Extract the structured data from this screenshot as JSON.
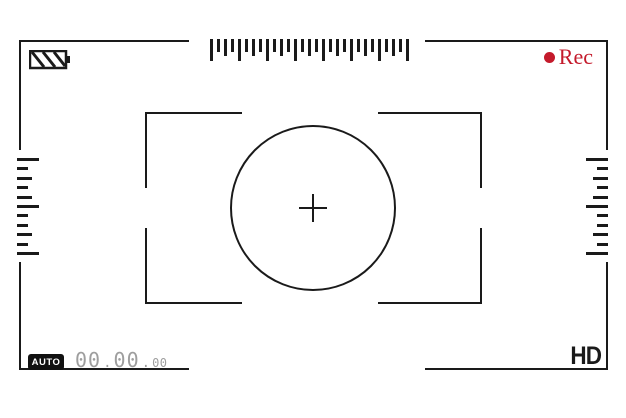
{
  "colors": {
    "line": "#1a1a1a",
    "accent_red": "#c41a2b",
    "timecode_gray": "#9e9e9e",
    "badge_bg": "#111111",
    "badge_text": "#ffffff"
  },
  "top_bar": {
    "battery_icon": "battery-icon",
    "rec": {
      "dot_icon": "record-dot-icon",
      "label": "Rec"
    }
  },
  "rulers": {
    "top": {
      "ticks": [
        "tall",
        "short",
        "mid",
        "short",
        "tall",
        "short",
        "mid",
        "short",
        "tall",
        "short",
        "mid",
        "short",
        "tall",
        "short",
        "mid",
        "short",
        "tall",
        "short",
        "mid",
        "short",
        "tall",
        "short",
        "mid",
        "short",
        "tall",
        "short",
        "mid",
        "short",
        "tall"
      ]
    },
    "left": {
      "ticks": [
        "tall",
        "short",
        "mid",
        "short",
        "mid",
        "tall",
        "short",
        "short",
        "mid",
        "short",
        "tall"
      ]
    },
    "right": {
      "ticks": [
        "tall",
        "short",
        "mid",
        "short",
        "mid",
        "tall",
        "short",
        "short",
        "mid",
        "short",
        "tall"
      ]
    }
  },
  "status_bar": {
    "mode_badge": "AUTO",
    "timecode": {
      "h": "00",
      "m": "00",
      "s": "00",
      "separator": "."
    },
    "quality": "HD"
  }
}
